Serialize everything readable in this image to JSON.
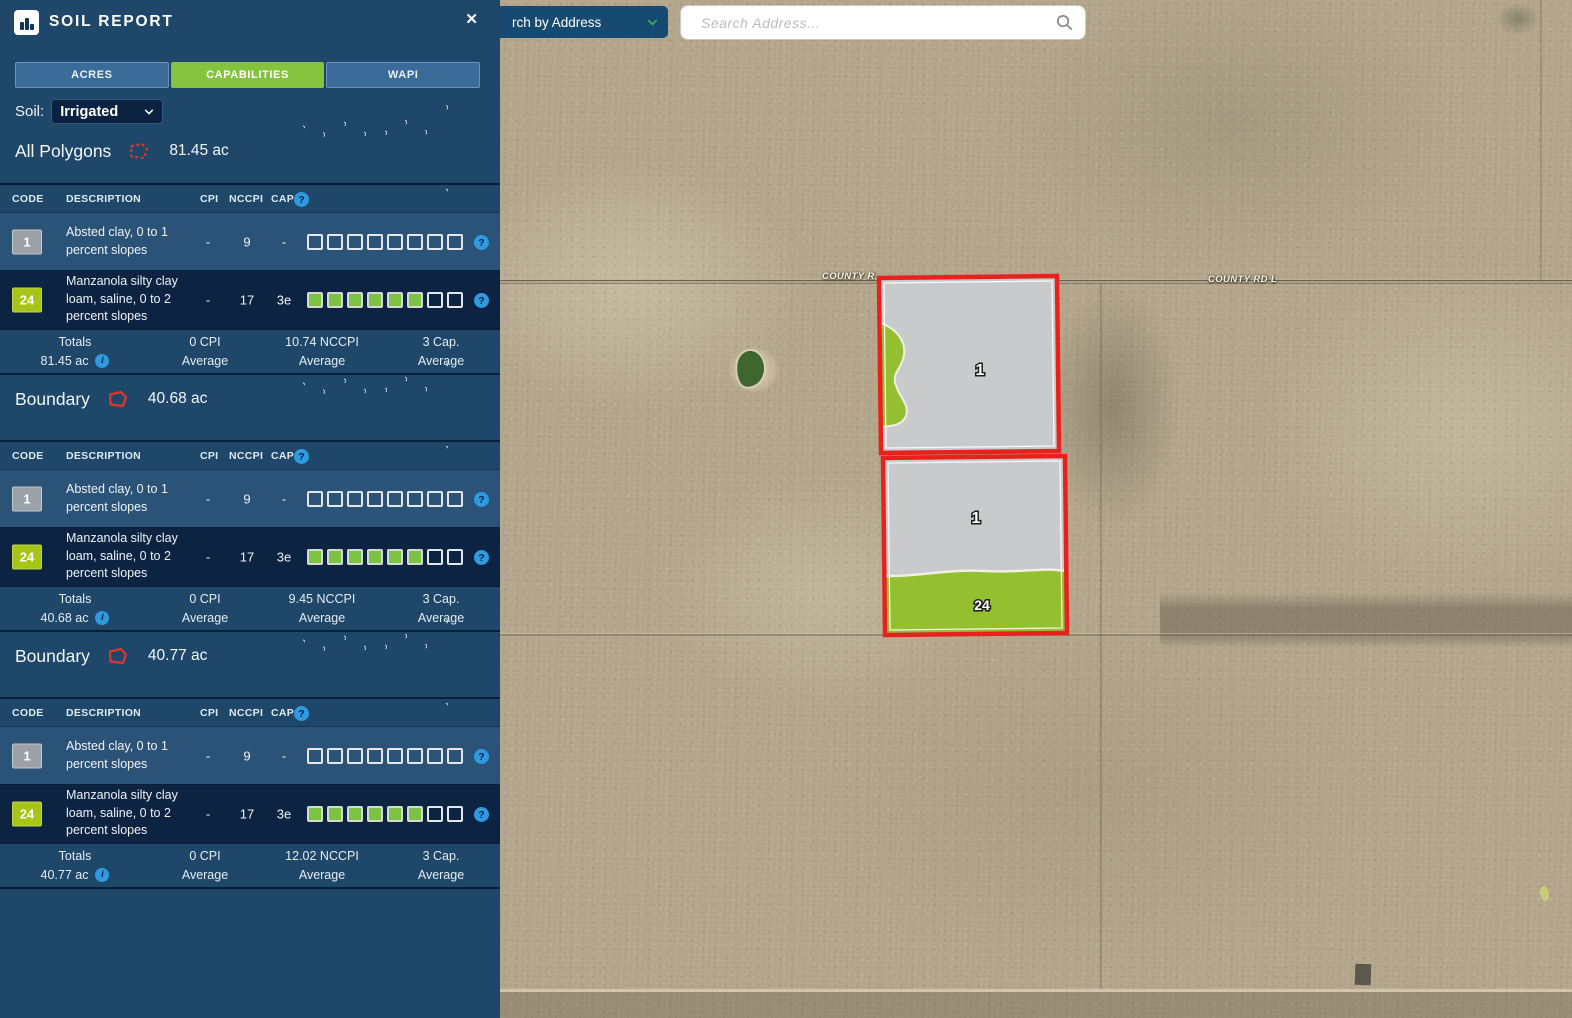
{
  "panel": {
    "title": "SOIL REPORT",
    "close_icon": "✕",
    "tabs": [
      {
        "label": "ACRES",
        "active": false
      },
      {
        "label": "CAPABILITIES",
        "active": true
      },
      {
        "label": "WAPI",
        "active": false
      }
    ],
    "soil_label": "Soil:",
    "soil_value": "Irrigated",
    "table_headers": {
      "code": "CODE",
      "description": "DESCRIPTION",
      "cpi": "CPI",
      "nccpi": "NCCPI",
      "cap": "CAP"
    },
    "capability_columns": [
      "Wildlife / Forestry",
      "Limited Grazing",
      "Moderate Grazing",
      "Intense Grazing",
      "Limited Farming",
      "Moderate Farming",
      "Intense Farming",
      "Very Intense Farming"
    ],
    "help_glyph": "?",
    "info_glyph": "i",
    "sections": [
      {
        "title": "All Polygons",
        "acres": "81.45 ac",
        "icon_style": "dashed",
        "rows": [
          {
            "code": "1",
            "badge": "gray",
            "description": "Absted clay, 0 to 1 percent slopes",
            "cpi": "-",
            "nccpi": "9",
            "cap": "-",
            "capabilities": [
              false,
              false,
              false,
              false,
              false,
              false,
              false,
              false
            ]
          },
          {
            "code": "24",
            "badge": "green",
            "description": "Manzanola silty clay loam, saline, 0 to 2 percent slopes",
            "cpi": "-",
            "nccpi": "17",
            "cap": "3e",
            "capabilities": [
              true,
              true,
              true,
              true,
              true,
              true,
              false,
              false
            ]
          }
        ],
        "totals": {
          "label": "Totals",
          "acres": "81.45 ac",
          "cpi_value": "0 CPI",
          "cpi_sub": "Average",
          "nccpi_value": "10.74 NCCPI",
          "nccpi_sub": "Average",
          "cap_value": "3 Cap.",
          "cap_sub": "Average"
        }
      },
      {
        "title": "Boundary",
        "acres": "40.68 ac",
        "icon_style": "solid",
        "rows": [
          {
            "code": "1",
            "badge": "gray",
            "description": "Absted clay, 0 to 1 percent slopes",
            "cpi": "-",
            "nccpi": "9",
            "cap": "-",
            "capabilities": [
              false,
              false,
              false,
              false,
              false,
              false,
              false,
              false
            ]
          },
          {
            "code": "24",
            "badge": "green",
            "description": "Manzanola silty clay loam, saline, 0 to 2 percent slopes",
            "cpi": "-",
            "nccpi": "17",
            "cap": "3e",
            "capabilities": [
              true,
              true,
              true,
              true,
              true,
              true,
              false,
              false
            ]
          }
        ],
        "totals": {
          "label": "Totals",
          "acres": "40.68 ac",
          "cpi_value": "0 CPI",
          "cpi_sub": "Average",
          "nccpi_value": "9.45 NCCPI",
          "nccpi_sub": "Average",
          "cap_value": "3 Cap.",
          "cap_sub": "Average"
        }
      },
      {
        "title": "Boundary",
        "acres": "40.77 ac",
        "icon_style": "solid",
        "rows": [
          {
            "code": "1",
            "badge": "gray",
            "description": "Absted clay, 0 to 1 percent slopes",
            "cpi": "-",
            "nccpi": "9",
            "cap": "-",
            "capabilities": [
              false,
              false,
              false,
              false,
              false,
              false,
              false,
              false
            ]
          },
          {
            "code": "24",
            "badge": "green",
            "description": "Manzanola silty clay loam, saline, 0 to 2 percent slopes",
            "cpi": "-",
            "nccpi": "17",
            "cap": "3e",
            "capabilities": [
              true,
              true,
              true,
              true,
              true,
              true,
              false,
              false
            ]
          }
        ],
        "totals": {
          "label": "Totals",
          "acres": "40.77 ac",
          "cpi_value": "0 CPI",
          "cpi_sub": "Average",
          "nccpi_value": "12.02 NCCPI",
          "nccpi_sub": "Average",
          "cap_value": "3 Cap.",
          "cap_sub": "Average"
        }
      }
    ]
  },
  "search": {
    "dropdown_label": "rch by Address",
    "placeholder": "Search Address..."
  },
  "map": {
    "road_label_left": "COUNTY R",
    "road_label_right": "COUNTY RD L",
    "parcel_labels": [
      "1",
      "1",
      "24"
    ]
  },
  "colors": {
    "panel_bg": "#1e4769",
    "row_light": "#2b5277",
    "row_dark": "#0d2342",
    "accent_green": "#85c33e",
    "badge_green": "#a6c516",
    "badge_gray": "#9aa1a7",
    "checkbox_green": "#7cc243",
    "help_blue": "#2f9ae0",
    "parcel_red": "#e8211d",
    "parcel_gray": "#c9cacc",
    "parcel_green": "#94bf31",
    "map_tan": "#b3a68c"
  }
}
